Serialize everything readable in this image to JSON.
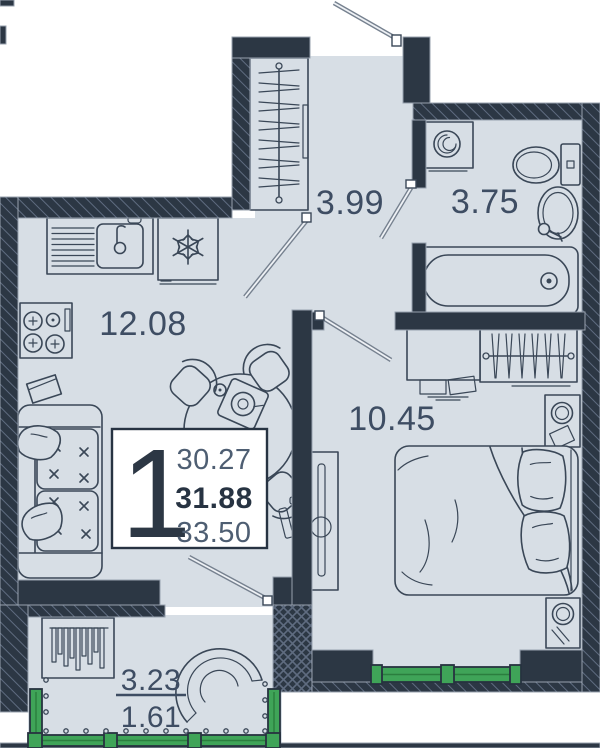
{
  "floor_plan": {
    "unit": {
      "number": "1",
      "area_living": "30.27",
      "area_total": "31.88",
      "area_with_summer": "33.50"
    },
    "rooms": {
      "kitchen_living": {
        "area": "12.08"
      },
      "hallway": {
        "area": "3.99"
      },
      "bathroom": {
        "area": "3.75"
      },
      "bedroom": {
        "area": "10.45"
      },
      "balcony": {
        "area_full": "3.23",
        "area_reduced": "1.61"
      }
    },
    "colors": {
      "wall": "#2c3744",
      "floor": "#d7dee5",
      "furniture_line": "#3a4757",
      "glazing_green": "#3fa458",
      "label_text": "#3e4d63",
      "total_text": "#273342",
      "info_box_bg": "#ffffff"
    }
  }
}
